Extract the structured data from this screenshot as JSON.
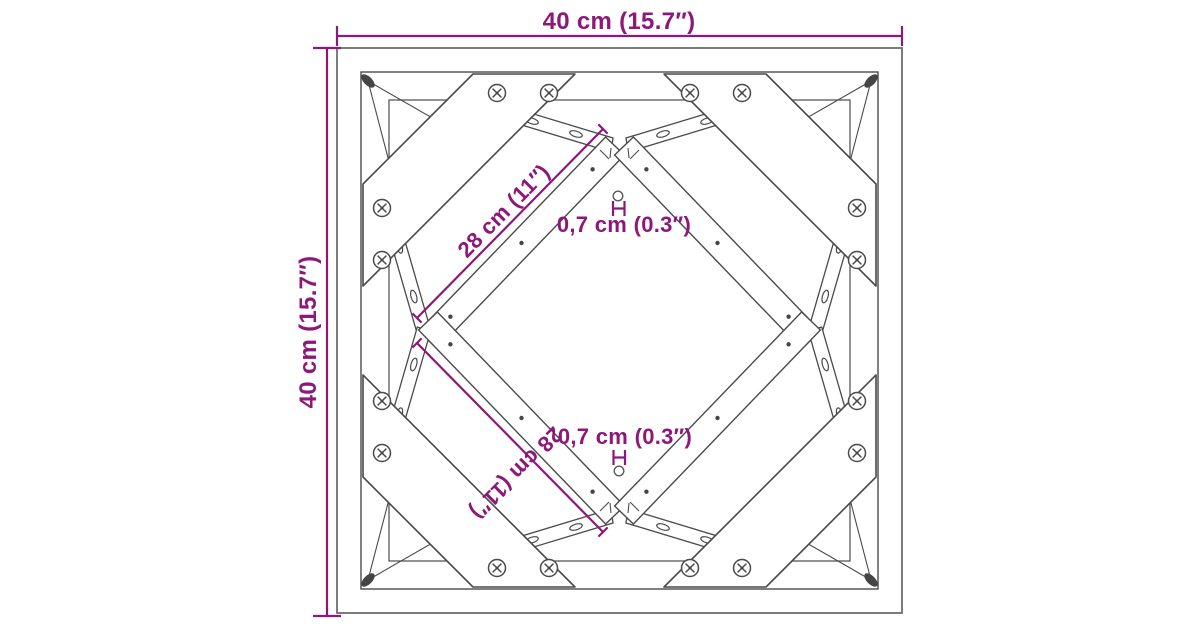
{
  "diagram": {
    "title": "Table frame top view dimension drawing",
    "type": "product-dimension-drawing",
    "dimensions": {
      "overall_width": "40 cm (15.7″)",
      "overall_depth": "40 cm (15.7″)",
      "brace_upper": "28 cm (11″)",
      "brace_lower": "28 cm (11″)",
      "hole_upper": "0,7 cm (0.3″)",
      "hole_lower": "0,7 cm (0.3″)"
    },
    "colors": {
      "accent": "#8D1879",
      "line": "#4A4A4A",
      "frame": "#6E6E6E",
      "background": "#FFFFFF"
    }
  }
}
